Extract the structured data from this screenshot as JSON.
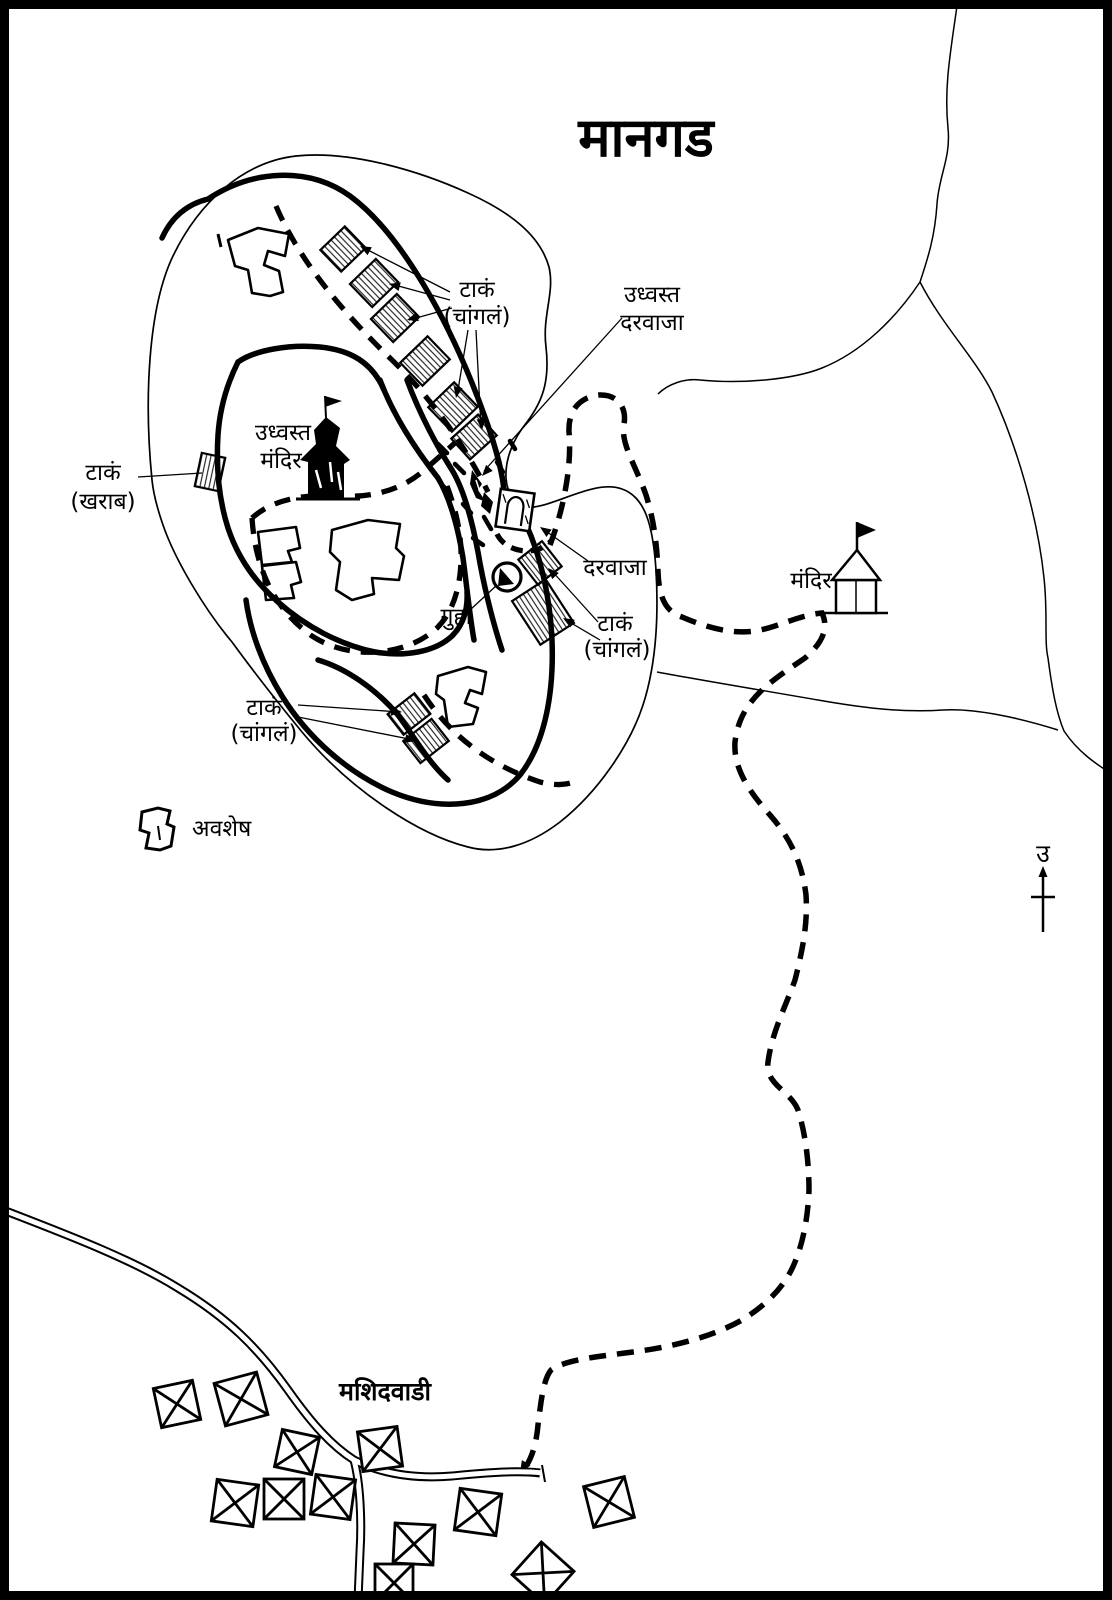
{
  "title": "मानगड",
  "labels": {
    "tank_good_north": {
      "line1": "टाकं",
      "line2": "(चांगलं)"
    },
    "ruined_gate": {
      "line1": "उध्वस्त",
      "line2": "दरवाजा"
    },
    "tank_bad": {
      "line1": "टाकं",
      "line2": "(खराब)"
    },
    "ruined_temple": {
      "line1": "उध्वस्त",
      "line2": "मंदिर"
    },
    "gate": "दरवाजा",
    "cave": "गुहा",
    "tank_good_east": {
      "line1": "टाकं",
      "line2": "(चांगलं)"
    },
    "tank_good_south": {
      "line1": "टाकं",
      "line2": "(चांगलं)"
    },
    "temple": "मंदिर",
    "village": "मशिदवाडी",
    "north_letter": "उ"
  },
  "legend": {
    "ruins_label": "अवशेष"
  },
  "colors": {
    "ink": "#000000",
    "paper": "#ffffff"
  }
}
